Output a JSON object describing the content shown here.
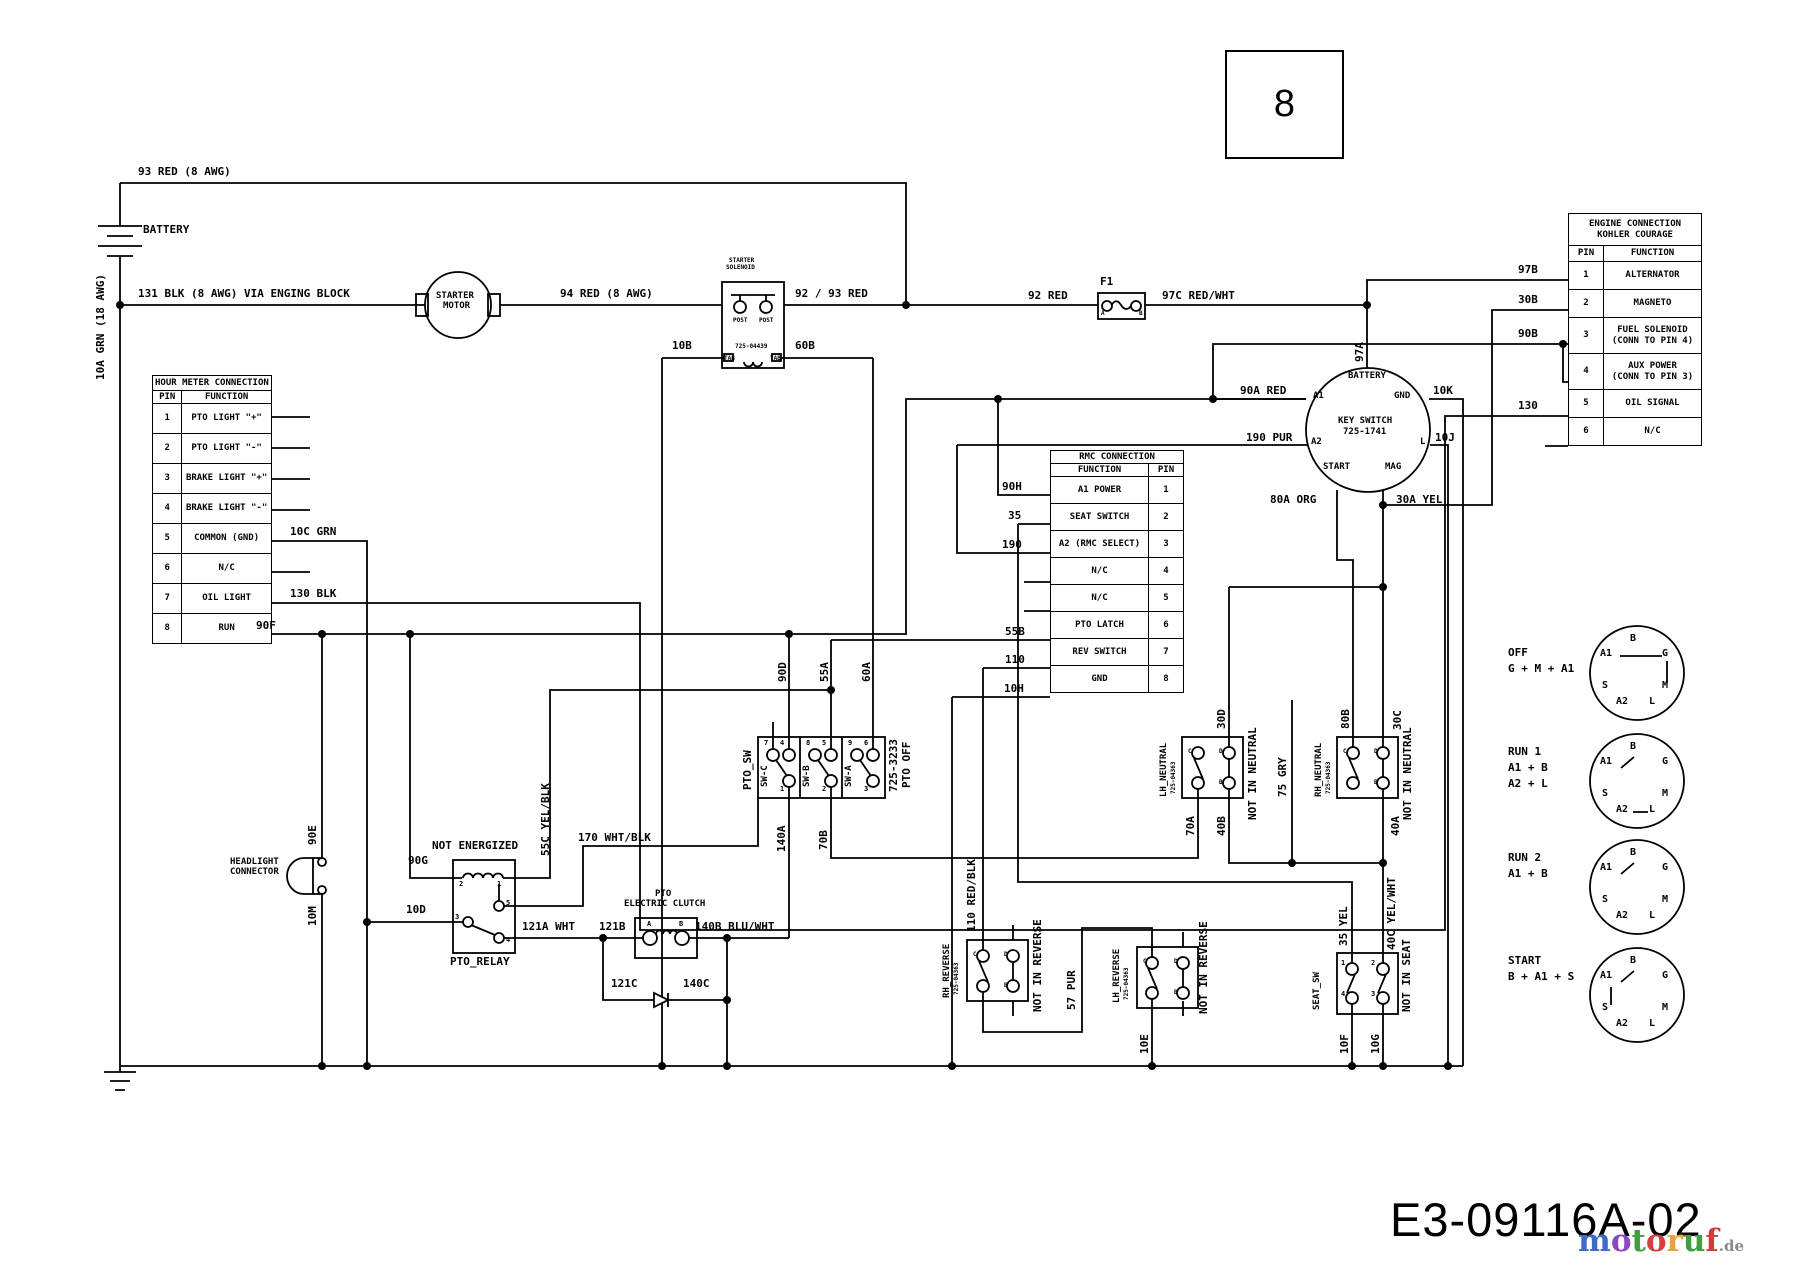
{
  "page": {
    "number": "8",
    "drawing_number": "E3-09116A-02"
  },
  "logo": {
    "letters": [
      {
        "ch": "m",
        "color": "#4169c8"
      },
      {
        "ch": "o",
        "color": "#8a4bbf"
      },
      {
        "ch": "t",
        "color": "#3f9e3f"
      },
      {
        "ch": "o",
        "color": "#d44040"
      },
      {
        "ch": "r",
        "color": "#e8a33c"
      },
      {
        "ch": "u",
        "color": "#3f9e3f"
      },
      {
        "ch": "f",
        "color": "#d43c3c"
      }
    ],
    "tld": ".de",
    "tld_color": "#8a8a8a"
  },
  "tables": {
    "hour_meter": {
      "title": "HOUR METER CONNECTION",
      "headers": [
        "PIN",
        "FUNCTION"
      ],
      "rows": [
        [
          "1",
          "PTO LIGHT \"+\""
        ],
        [
          "2",
          "PTO LIGHT \"-\""
        ],
        [
          "3",
          "BRAKE LIGHT \"+\""
        ],
        [
          "4",
          "BRAKE LIGHT \"-\""
        ],
        [
          "5",
          "COMMON (GND)"
        ],
        [
          "6",
          "N/C"
        ],
        [
          "7",
          "OIL LIGHT"
        ],
        [
          "8",
          "RUN"
        ]
      ]
    },
    "engine": {
      "title": "ENGINE CONNECTION\nKOHLER COURAGE",
      "headers": [
        "PIN",
        "FUNCTION"
      ],
      "rows": [
        [
          "1",
          "ALTERNATOR"
        ],
        [
          "2",
          "MAGNETO"
        ],
        [
          "3",
          "FUEL SOLENOID|(CONN TO PIN 4)"
        ],
        [
          "4",
          "AUX POWER|(CONN TO PIN 3)"
        ],
        [
          "5",
          "OIL SIGNAL"
        ],
        [
          "6",
          "N/C"
        ]
      ]
    },
    "rmc": {
      "title": "RMC CONNECTION",
      "headers": [
        "FUNCTION",
        "PIN"
      ],
      "rows": [
        [
          "A1 POWER",
          "1"
        ],
        [
          "SEAT SWITCH",
          "2"
        ],
        [
          "A2 (RMC SELECT)",
          "3"
        ],
        [
          "N/C",
          "4"
        ],
        [
          "N/C",
          "5"
        ],
        [
          "PTO LATCH",
          "6"
        ],
        [
          "REV SWITCH",
          "7"
        ],
        [
          "GND",
          "8"
        ]
      ]
    }
  },
  "key_positions": {
    "terminal_ring": [
      "B",
      "A1",
      "G",
      "S",
      "M",
      "A2",
      "L"
    ],
    "items": [
      {
        "lines": "OFF\nG + M + A1"
      },
      {
        "lines": "RUN 1\nA1 + B\nA2 + L"
      },
      {
        "lines": "RUN 2\nA1 + B"
      },
      {
        "lines": "START\nB + A1 + S"
      }
    ]
  },
  "labels": [
    {
      "t": "93 RED (8 AWG)",
      "x": 138,
      "y": 166
    },
    {
      "t": "BATTERY",
      "x": 143,
      "y": 224
    },
    {
      "t": "131 BLK (8 AWG) VIA ENGING BLOCK",
      "x": 138,
      "y": 288
    },
    {
      "t": "STARTER",
      "x": 436,
      "y": 292,
      "s": "s"
    },
    {
      "t": "MOTOR",
      "x": 443,
      "y": 302,
      "s": "s"
    },
    {
      "t": "94 RED (8 AWG)",
      "x": 560,
      "y": 288
    },
    {
      "t": "STARTER",
      "x": 729,
      "y": 258,
      "s": "m"
    },
    {
      "t": "SOLENOID",
      "x": 726,
      "y": 265,
      "s": "m"
    },
    {
      "t": "POST",
      "x": 733,
      "y": 318,
      "s": "m"
    },
    {
      "t": "POST",
      "x": 759,
      "y": 318,
      "s": "m"
    },
    {
      "t": "725-04439",
      "x": 735,
      "y": 344,
      "s": "m"
    },
    {
      "t": "TAB",
      "x": 724,
      "y": 356,
      "s": "m"
    },
    {
      "t": "TAB",
      "x": 770,
      "y": 356,
      "s": "m"
    },
    {
      "t": "10B",
      "x": 672,
      "y": 340
    },
    {
      "t": "60B",
      "x": 795,
      "y": 340
    },
    {
      "t": "92 / 93 RED",
      "x": 795,
      "y": 288
    },
    {
      "t": "92 RED",
      "x": 1028,
      "y": 290
    },
    {
      "t": "F1",
      "x": 1100,
      "y": 276
    },
    {
      "t": "A",
      "x": 1101,
      "y": 311,
      "s": "m"
    },
    {
      "t": "B",
      "x": 1139,
      "y": 311,
      "s": "m"
    },
    {
      "t": "97C RED/WHT",
      "x": 1162,
      "y": 290
    },
    {
      "t": "97B",
      "x": 1518,
      "y": 264
    },
    {
      "t": "30B",
      "x": 1518,
      "y": 294
    },
    {
      "t": "90B",
      "x": 1518,
      "y": 328
    },
    {
      "t": "130",
      "x": 1518,
      "y": 400
    },
    {
      "t": "90A RED",
      "x": 1240,
      "y": 385
    },
    {
      "t": "190 PUR",
      "x": 1246,
      "y": 432
    },
    {
      "t": "10K",
      "x": 1433,
      "y": 385
    },
    {
      "t": "10J",
      "x": 1435,
      "y": 432
    },
    {
      "t": "80A ORG",
      "x": 1270,
      "y": 494
    },
    {
      "t": "30A YEL",
      "x": 1396,
      "y": 494
    },
    {
      "t": "BATTERY",
      "x": 1348,
      "y": 372,
      "s": "s"
    },
    {
      "t": "A1",
      "x": 1313,
      "y": 392,
      "s": "s"
    },
    {
      "t": "GND",
      "x": 1394,
      "y": 392,
      "s": "s"
    },
    {
      "t": "KEY SWITCH",
      "x": 1338,
      "y": 417,
      "s": "s"
    },
    {
      "t": "725-1741",
      "x": 1343,
      "y": 428,
      "s": "s"
    },
    {
      "t": "A2",
      "x": 1311,
      "y": 438,
      "s": "s"
    },
    {
      "t": "L",
      "x": 1420,
      "y": 438,
      "s": "s"
    },
    {
      "t": "START",
      "x": 1323,
      "y": 463,
      "s": "s"
    },
    {
      "t": "MAG",
      "x": 1385,
      "y": 463,
      "s": "s"
    },
    {
      "t": "10C GRN",
      "x": 290,
      "y": 526
    },
    {
      "t": "130 BLK",
      "x": 290,
      "y": 588
    },
    {
      "t": "90F",
      "x": 256,
      "y": 620
    },
    {
      "t": "90H",
      "x": 1002,
      "y": 481
    },
    {
      "t": "35",
      "x": 1008,
      "y": 510
    },
    {
      "t": "190",
      "x": 1002,
      "y": 539
    },
    {
      "t": "55B",
      "x": 1005,
      "y": 626
    },
    {
      "t": "110",
      "x": 1005,
      "y": 654
    },
    {
      "t": "10H",
      "x": 1004,
      "y": 683
    },
    {
      "t": "NOT ENERGIZED",
      "x": 432,
      "y": 840
    },
    {
      "t": "90G",
      "x": 408,
      "y": 855
    },
    {
      "t": "170 WHT/BLK",
      "x": 578,
      "y": 832
    },
    {
      "t": "10D",
      "x": 406,
      "y": 904
    },
    {
      "t": "121A WHT",
      "x": 522,
      "y": 921
    },
    {
      "t": "121B",
      "x": 599,
      "y": 921
    },
    {
      "t": "140B BLU/WHT",
      "x": 695,
      "y": 921
    },
    {
      "t": "121C",
      "x": 611,
      "y": 978
    },
    {
      "t": "140C",
      "x": 683,
      "y": 978
    },
    {
      "t": "PTO_RELAY",
      "x": 450,
      "y": 956
    },
    {
      "t": "2",
      "x": 459,
      "y": 881,
      "s": "t"
    },
    {
      "t": "1",
      "x": 497,
      "y": 881,
      "s": "t"
    },
    {
      "t": "3",
      "x": 455,
      "y": 914,
      "s": "t"
    },
    {
      "t": "5",
      "x": 506,
      "y": 900,
      "s": "t"
    },
    {
      "t": "4",
      "x": 506,
      "y": 937,
      "s": "t"
    },
    {
      "t": "PTO",
      "x": 655,
      "y": 890,
      "s": "s"
    },
    {
      "t": "ELECTRIC CLUTCH",
      "x": 624,
      "y": 900,
      "s": "s"
    },
    {
      "t": "A",
      "x": 647,
      "y": 921,
      "s": "t"
    },
    {
      "t": "B",
      "x": 679,
      "y": 921,
      "s": "t"
    },
    {
      "t": "HEADLIGHT",
      "x": 230,
      "y": 858,
      "s": "s"
    },
    {
      "t": "CONNECTOR",
      "x": 230,
      "y": 868,
      "s": "s"
    },
    {
      "t": "1",
      "x": 1341,
      "y": 960,
      "s": "t"
    },
    {
      "t": "2",
      "x": 1371,
      "y": 960,
      "s": "t"
    },
    {
      "t": "4",
      "x": 1341,
      "y": 991,
      "s": "t"
    },
    {
      "t": "3",
      "x": 1371,
      "y": 991,
      "s": "t"
    },
    {
      "t": "7",
      "x": 764,
      "y": 740,
      "s": "t"
    },
    {
      "t": "4",
      "x": 780,
      "y": 740,
      "s": "t"
    },
    {
      "t": "8",
      "x": 806,
      "y": 740,
      "s": "t"
    },
    {
      "t": "5",
      "x": 822,
      "y": 740,
      "s": "t"
    },
    {
      "t": "9",
      "x": 848,
      "y": 740,
      "s": "t"
    },
    {
      "t": "6",
      "x": 864,
      "y": 740,
      "s": "t"
    },
    {
      "t": "1",
      "x": 780,
      "y": 786,
      "s": "t"
    },
    {
      "t": "2",
      "x": 822,
      "y": 786,
      "s": "t"
    },
    {
      "t": "3",
      "x": 864,
      "y": 786,
      "s": "t"
    },
    {
      "t": "C",
      "x": 1188,
      "y": 749,
      "s": "m"
    },
    {
      "t": "D",
      "x": 1219,
      "y": 749,
      "s": "m"
    },
    {
      "t": "B",
      "x": 1219,
      "y": 780,
      "s": "m"
    },
    {
      "t": "C",
      "x": 1343,
      "y": 749,
      "s": "m"
    },
    {
      "t": "D",
      "x": 1374,
      "y": 749,
      "s": "m"
    },
    {
      "t": "B",
      "x": 1374,
      "y": 780,
      "s": "m"
    },
    {
      "t": "C",
      "x": 973,
      "y": 952,
      "s": "m"
    },
    {
      "t": "D",
      "x": 1004,
      "y": 952,
      "s": "m"
    },
    {
      "t": "B",
      "x": 1004,
      "y": 983,
      "s": "m"
    },
    {
      "t": "C",
      "x": 1143,
      "y": 959,
      "s": "m"
    },
    {
      "t": "D",
      "x": 1174,
      "y": 959,
      "s": "m"
    },
    {
      "t": "B",
      "x": 1174,
      "y": 990,
      "s": "m"
    },
    {
      "t": "10A GRN (18 AWG)",
      "x": 95,
      "y": 380,
      "r": 1
    },
    {
      "t": "97A",
      "x": 1354,
      "y": 362,
      "r": 1
    },
    {
      "t": "90D",
      "x": 777,
      "y": 682,
      "r": 1
    },
    {
      "t": "55A",
      "x": 819,
      "y": 682,
      "r": 1
    },
    {
      "t": "60A",
      "x": 861,
      "y": 682,
      "r": 1
    },
    {
      "t": "PTO_SW",
      "x": 742,
      "y": 790,
      "r": 1
    },
    {
      "t": "SW-C",
      "x": 761,
      "y": 787,
      "r": 1,
      "s": "s"
    },
    {
      "t": "SW-B",
      "x": 803,
      "y": 787,
      "r": 1,
      "s": "s"
    },
    {
      "t": "SW-A",
      "x": 845,
      "y": 787,
      "r": 1,
      "s": "s"
    },
    {
      "t": "725-3233",
      "x": 888,
      "y": 792,
      "r": 1
    },
    {
      "t": "PTO OFF",
      "x": 901,
      "y": 788,
      "r": 1
    },
    {
      "t": "140A",
      "x": 776,
      "y": 852,
      "r": 1
    },
    {
      "t": "70B",
      "x": 818,
      "y": 850,
      "r": 1
    },
    {
      "t": "55C YEL/BLK",
      "x": 540,
      "y": 856,
      "r": 1
    },
    {
      "t": "90E",
      "x": 307,
      "y": 845,
      "r": 1
    },
    {
      "t": "10M",
      "x": 307,
      "y": 926,
      "r": 1
    },
    {
      "t": "LH_NEUTRAL",
      "x": 1160,
      "y": 797,
      "r": 1,
      "s": "s"
    },
    {
      "t": "725-04363",
      "x": 1171,
      "y": 794,
      "r": 1,
      "s": "m"
    },
    {
      "t": "30D",
      "x": 1216,
      "y": 729,
      "r": 1
    },
    {
      "t": "NOT IN NEUTRAL",
      "x": 1247,
      "y": 820,
      "r": 1
    },
    {
      "t": "70A",
      "x": 1185,
      "y": 836,
      "r": 1
    },
    {
      "t": "40B",
      "x": 1216,
      "y": 836,
      "r": 1
    },
    {
      "t": "75 GRY",
      "x": 1277,
      "y": 797,
      "r": 1
    },
    {
      "t": "RH_NEUTRAL",
      "x": 1315,
      "y": 797,
      "r": 1,
      "s": "s"
    },
    {
      "t": "725-04363",
      "x": 1326,
      "y": 794,
      "r": 1,
      "s": "m"
    },
    {
      "t": "80B",
      "x": 1340,
      "y": 729,
      "r": 1
    },
    {
      "t": "30C",
      "x": 1392,
      "y": 730,
      "r": 1
    },
    {
      "t": "NOT IN NEUTRAL",
      "x": 1402,
      "y": 820,
      "r": 1
    },
    {
      "t": "40A",
      "x": 1390,
      "y": 836,
      "r": 1
    },
    {
      "t": "RH_REVERSE",
      "x": 943,
      "y": 998,
      "r": 1,
      "s": "s"
    },
    {
      "t": "725-04363",
      "x": 954,
      "y": 995,
      "r": 1,
      "s": "m"
    },
    {
      "t": "110 RED/BLK",
      "x": 966,
      "y": 932,
      "r": 1
    },
    {
      "t": "NOT IN REVERSE",
      "x": 1032,
      "y": 1012,
      "r": 1
    },
    {
      "t": "57 PUR",
      "x": 1066,
      "y": 1010,
      "r": 1
    },
    {
      "t": "LH_REVERSE",
      "x": 1113,
      "y": 1003,
      "r": 1,
      "s": "s"
    },
    {
      "t": "725-04363",
      "x": 1124,
      "y": 1000,
      "r": 1,
      "s": "m"
    },
    {
      "t": "NOT IN REVERSE",
      "x": 1198,
      "y": 1014,
      "r": 1
    },
    {
      "t": "10E",
      "x": 1139,
      "y": 1054,
      "r": 1
    },
    {
      "t": "SEAT_SW",
      "x": 1313,
      "y": 1010,
      "r": 1,
      "s": "s"
    },
    {
      "t": "35 YEL",
      "x": 1338,
      "y": 946,
      "r": 1
    },
    {
      "t": "40C YEL/WHT",
      "x": 1386,
      "y": 950,
      "r": 1
    },
    {
      "t": "NOT IN SEAT",
      "x": 1401,
      "y": 1012,
      "r": 1
    },
    {
      "t": "10F",
      "x": 1339,
      "y": 1054,
      "r": 1
    },
    {
      "t": "10G",
      "x": 1370,
      "y": 1054,
      "r": 1
    }
  ]
}
